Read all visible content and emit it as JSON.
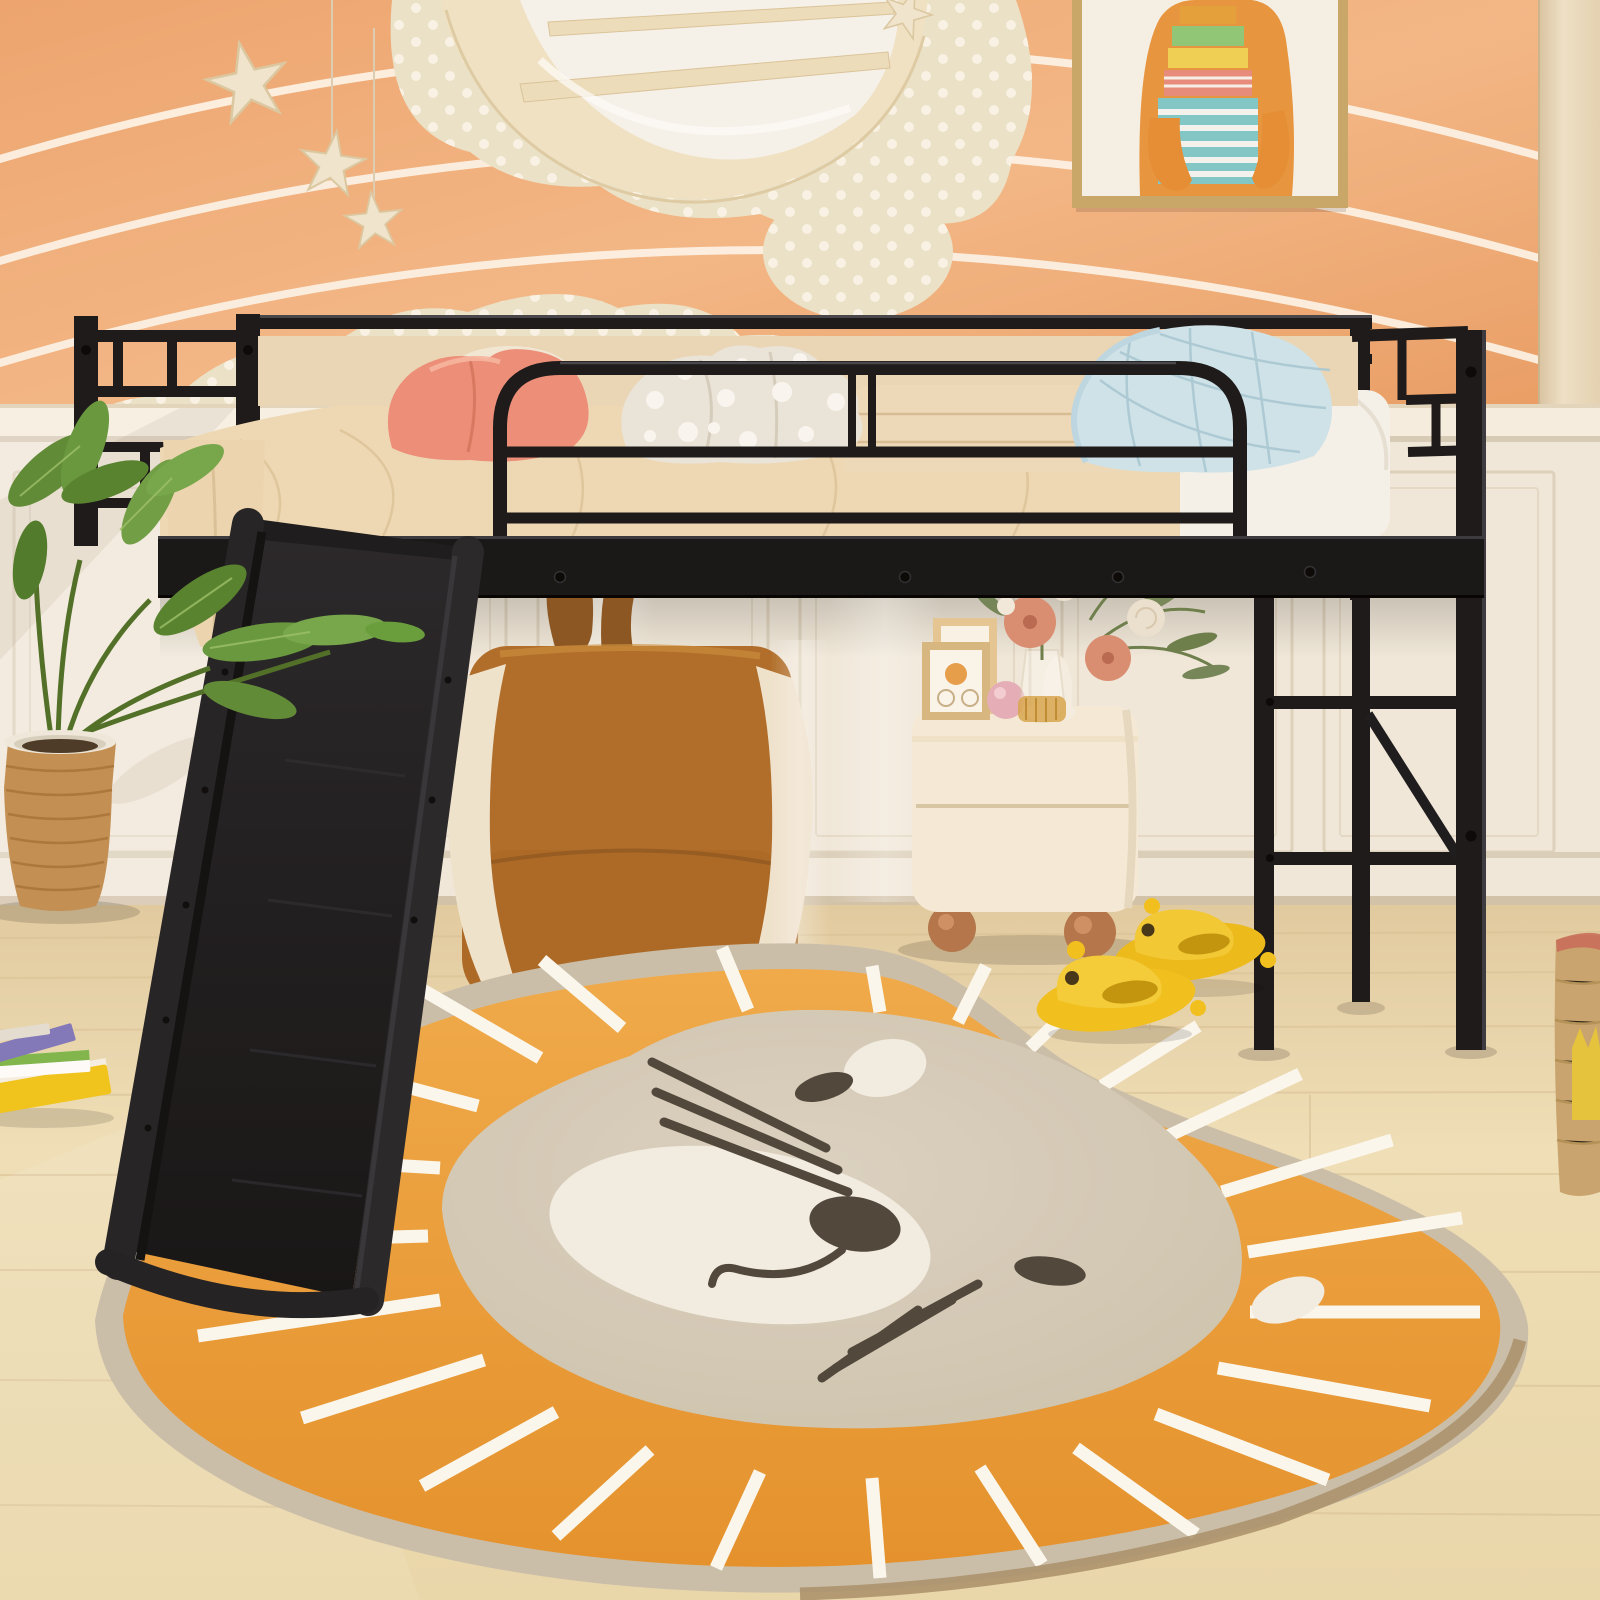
{
  "scene": {
    "label": "kids-bedroom-product-photo",
    "subject": "black metal twin loft bed with slide",
    "room_elements": [
      {
        "name": "striped-wallpaper",
        "label": "peach wallpaper with wavy white stripes"
      },
      {
        "name": "polka-dot-clouds",
        "label": "cream cloud wall decals with white dots"
      },
      {
        "name": "moon-shelf",
        "label": "wooden crescent moon wall shelf"
      },
      {
        "name": "hanging-stars",
        "label": "wooden stars hanging on strings"
      },
      {
        "name": "wall-art",
        "label": "framed picture of bear carrying stack of books"
      },
      {
        "name": "wainscoting",
        "label": "white panel wainscot lower wall"
      },
      {
        "name": "side-curtain",
        "label": "cream curtain strip at right edge"
      },
      {
        "name": "wood-floor",
        "label": "light oak plank floor"
      },
      {
        "name": "loft-bed",
        "label": "black metal loft bed with guard rails"
      },
      {
        "name": "slide",
        "label": "black play slide from bed to floor"
      },
      {
        "name": "ladder",
        "label": "black metal end ladder with diagonal brace"
      },
      {
        "name": "bedding",
        "label": "beige sheet, white mattress, folded blanket"
      },
      {
        "name": "pillow-pink-heart",
        "label": "pink heart pillow"
      },
      {
        "name": "pillow-polka",
        "label": "white polka dot pillow"
      },
      {
        "name": "pillow-blue-quilted",
        "label": "light blue quilted pillow"
      },
      {
        "name": "bunny-bean-chair",
        "label": "caramel bunny-ear bean bag chair"
      },
      {
        "name": "nightstand",
        "label": "cream nightstand with ball feet, frames, pink ball, flower vase"
      },
      {
        "name": "flower-bouquet",
        "label": "pink dahlias, cream roses and greenery in glass vase"
      },
      {
        "name": "lion-rug",
        "label": "round lion face rug with orange mane and white rays"
      },
      {
        "name": "duck-slippers",
        "label": "yellow kids slippers"
      },
      {
        "name": "monstera-plant",
        "label": "monstera plant in wicker basket pot"
      },
      {
        "name": "book-stack",
        "label": "colorful picture books on floor"
      },
      {
        "name": "storage-basket",
        "label": "woven storage basket at right edge"
      }
    ]
  },
  "colors": {
    "wallpaper_base": "#F0A873",
    "wallpaper_light": "#F5BC8C",
    "wallpaper_stripe": "#FFF9EF",
    "cloud_cream": "#EDE5CC",
    "cloud_dot": "#FBF7EC",
    "moon_wood": "#F1E5C8",
    "moon_glass": "#F8F6F0",
    "star_wood": "#F2E9D3",
    "art_frame": "#C9A96B",
    "art_paper": "#F6F3EB",
    "art_bear": "#E9963F",
    "wall_white": "#F2ECDF",
    "chair_rail": "#F7F1E5",
    "panel_line": "#DFD5C2",
    "curtain": "#EDDFC5",
    "floor_wood": "#EFDFB6",
    "floor_line": "#D8C298",
    "metal_black": "#17171A",
    "metal_highlight": "#45454D",
    "sheet_beige": "#F0DCBA",
    "mattress_white": "#F7F5EF",
    "blanket_beige": "#EFDDBE",
    "pillow_pink": "#EE8F7B",
    "pillow_polka": "#ECE8DE",
    "pillow_blue": "#CFE6EF",
    "slide_black": "#1B1B1F",
    "bunny_caramel": "#B06E2A",
    "bunny_cream": "#F1E6D2",
    "bunny_ear": "#8A5622",
    "nightstand_cream": "#F7EEDC",
    "foot_wood": "#B5764C",
    "flower_pink": "#DB8F74",
    "flower_cream": "#EDE4D4",
    "foliage_green": "#73875A",
    "rug_border": "#CBC1AE",
    "rug_mane": "#EFA63E",
    "rug_spoke": "#FDFBF4",
    "rug_face": "#D9D0BF",
    "rug_muzzle": "#F4F0E6",
    "rug_dark": "#4E463C",
    "rug_rim": "#A8906B",
    "slipper_yellow": "#F3C31F",
    "slipper_eye": "#443519",
    "plant_green": "#5E8C39",
    "pot_wicker": "#C39055",
    "book_yellow": "#F2C61D",
    "book_green": "#7FB94E",
    "book_purple": "#8079BE"
  }
}
